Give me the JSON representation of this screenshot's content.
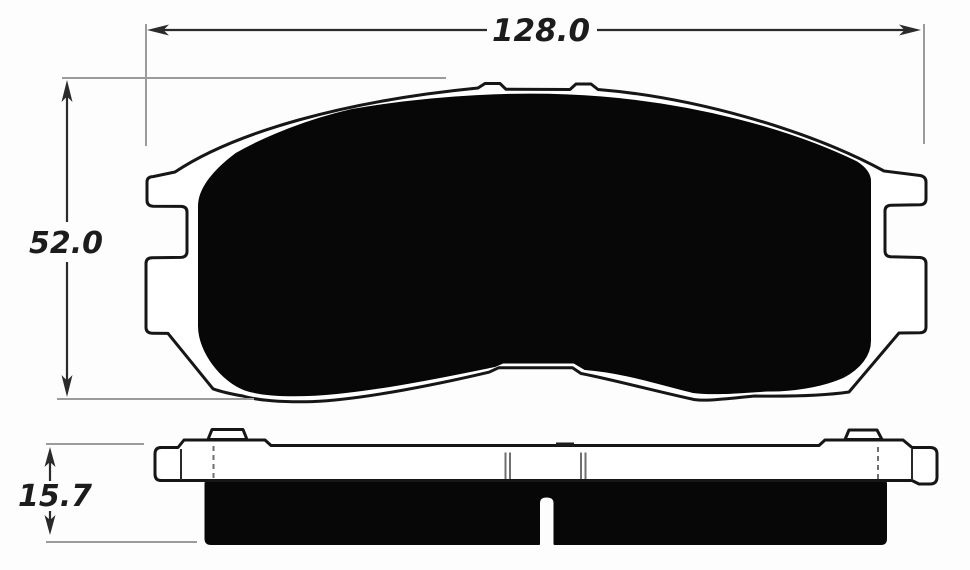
{
  "drawing": {
    "type": "technical-dimension-drawing",
    "dimensions": {
      "width": {
        "value": "128.0"
      },
      "height": {
        "value": "52.0"
      },
      "thickness": {
        "value": "15.7"
      }
    },
    "colors": {
      "background": "#fdfdfd",
      "outline": "#161616",
      "solid_fill": "#070707",
      "dimension_line": "#2b2b2b",
      "extension_line": "#9b9b9b",
      "text": "#1c1c1c"
    }
  }
}
